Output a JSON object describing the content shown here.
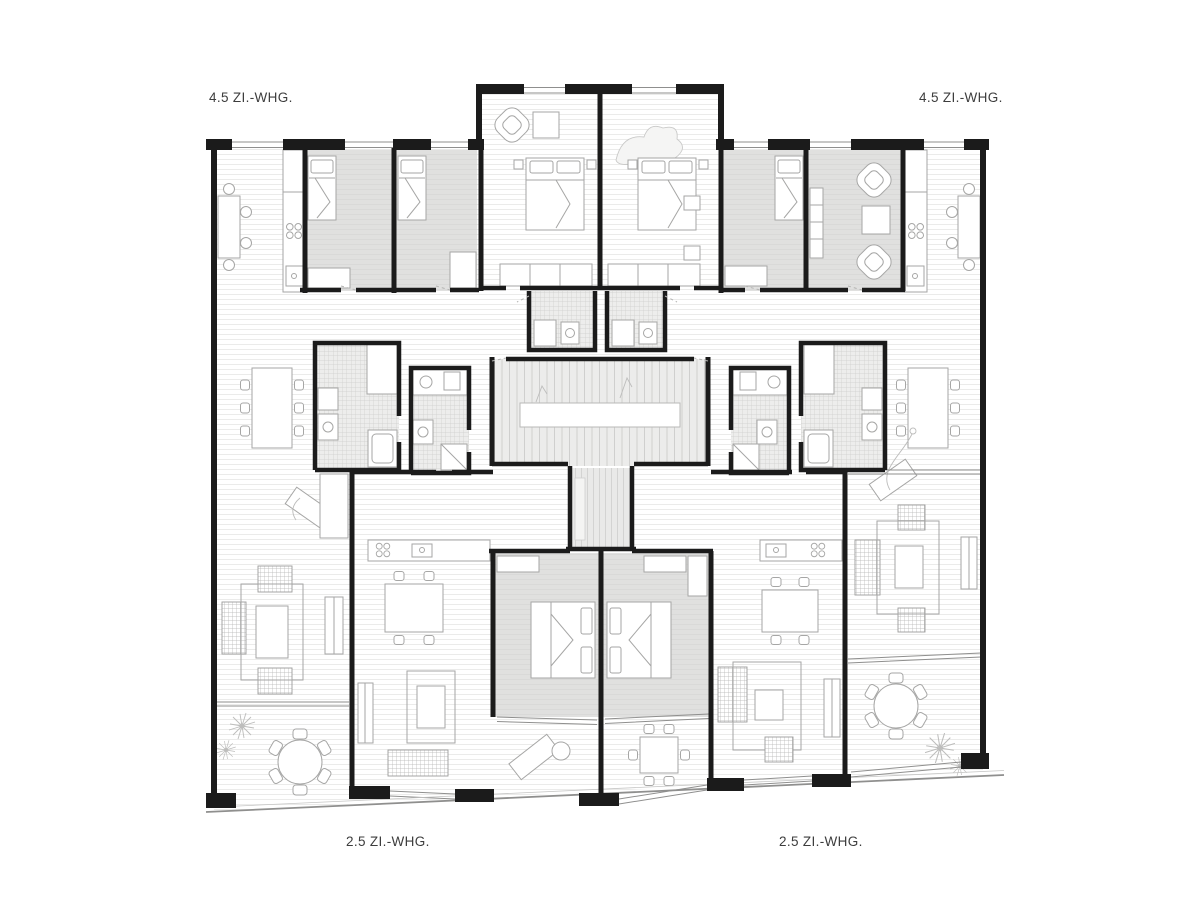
{
  "labels": {
    "top_left": "4.5 ZI.-WHG.",
    "top_right": "4.5 ZI.-WHG.",
    "bottom_left": "2.5 ZI.-WHG.",
    "bottom_right": "2.5 ZI.-WHG."
  },
  "palette": {
    "background": "#ffffff",
    "wall": "#1b1b1b",
    "room-grey": "#e0e0df",
    "tile-grey": "#ededec",
    "furniture-line": "#a6a6a5",
    "window-line": "#8f8f8e",
    "text": "#3d3d3d"
  }
}
